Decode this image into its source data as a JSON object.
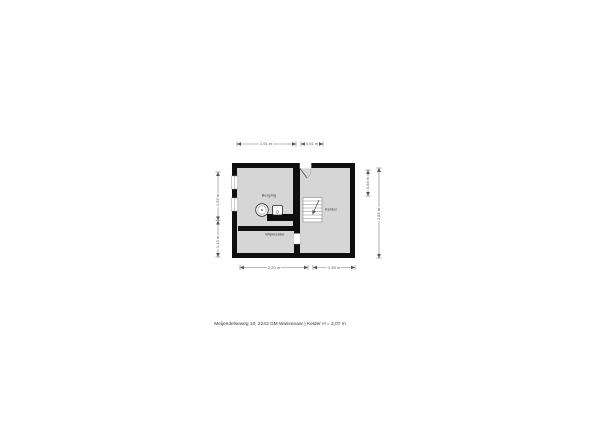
{
  "floorplan": {
    "rooms": {
      "storage": {
        "label": "Berging"
      },
      "cellar": {
        "label": "Kelder"
      },
      "wine_cellar": {
        "label": "Wijnkelder"
      }
    },
    "dimensions": {
      "top_left": "1,91 m",
      "top_right": "0,61 m",
      "bottom_left": "2,20 m",
      "bottom_right": "1,39 m",
      "left_upper": "1,55 m",
      "left_lower": "1,13 m",
      "right_inner": "0,84 m",
      "right_outer": "2,85 m"
    },
    "icons": {
      "window": "window-symbol",
      "door": "door-swing-symbol",
      "stairs": "stairs-symbol",
      "boiler": "boiler-symbol",
      "appliance": "appliance-symbol",
      "direction_arrow": "stairs-direction-arrow"
    }
  },
  "footer": {
    "text": "Meijendelseweg 10, 2243 GM Wassenaar | Kelder H = 2,07 m"
  },
  "colors": {
    "wall": "#0f0f0f",
    "room_fill": "#d6d6d6",
    "background": "#ffffff",
    "dimension_line": "#777777",
    "label_text": "#3a3a3a"
  }
}
